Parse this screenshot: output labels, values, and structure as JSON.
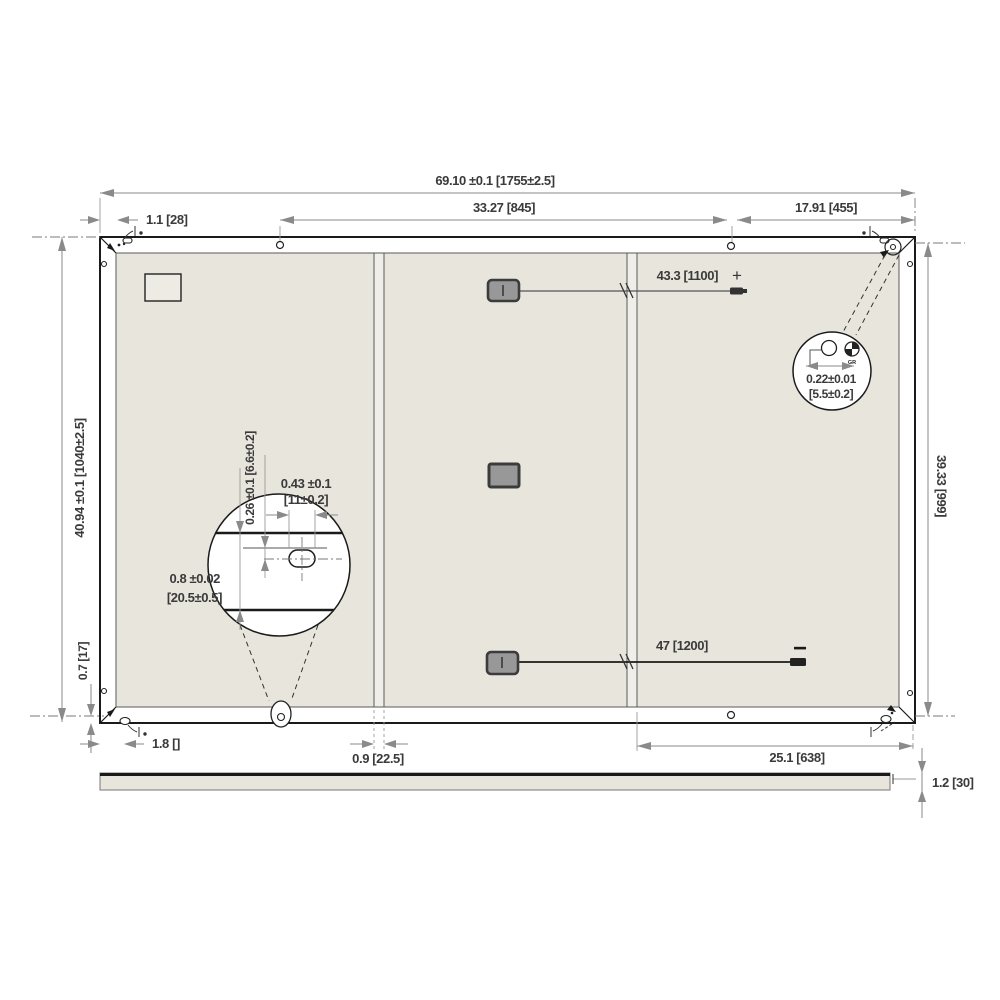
{
  "labels": {
    "overall_width": "69.10 ±0.1 [1755±2.5]",
    "mount_span_top": "33.27 [845]",
    "top_right_span": "17.91 [455]",
    "frame_width_top": "1.1 [28]",
    "overall_height": "40.94 ±0.1 [1040±2.5]",
    "bottom_edge_offset": "0.7 [17]",
    "mount_height_right": "39.33 [999]",
    "frame_width_bottom": "1.8 []",
    "rail_width": "0.9 [22.5]",
    "bottom_right_span": "25.1 [638]",
    "thickness": "1.2 [30]",
    "cable_positive_length": "43.3 [1100]",
    "plus_sign": "+",
    "cable_negative_length": "47 [1200]",
    "minus_sign": "−",
    "detail_a": {
      "slot_width": "0.43 ±0.1",
      "slot_width_mm": "[11±0.2]",
      "edge_offset": "0.26 ±0.1 [6.6±0.2]",
      "frame_depth": "0.8 ±0.02",
      "frame_depth_mm": "[20.5±0.5]"
    },
    "detail_b": {
      "hole_diameter": "0.22±0.01",
      "hole_diameter_mm": "[5.5±0.2]",
      "ground_mark": "GR"
    }
  },
  "colors": {
    "background": "#ffffff",
    "laminate": "#e8e5dd",
    "rail": "#f0eee8",
    "outline": "#1a1a1a",
    "dimension_gray": "#8a8a8a",
    "text": "#3a3a3a",
    "junction_box_fill": "#989898",
    "junction_box_border": "#3c3c3c"
  }
}
